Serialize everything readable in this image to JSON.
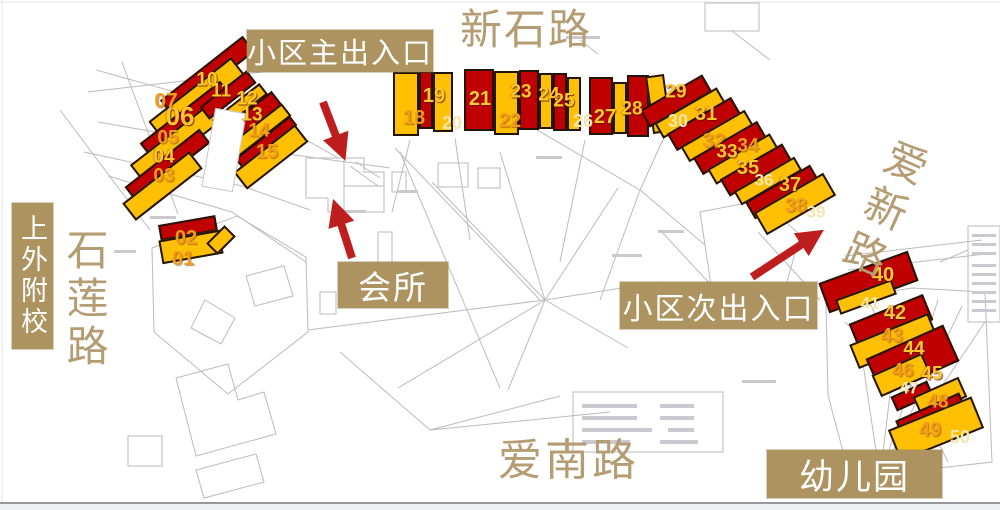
{
  "title": "小区楼栋分布图",
  "colors": {
    "building_red": "#C00000",
    "building_yellow": "#FFC003",
    "label_bg": "#AC9360",
    "label_text": "#FFFFFF",
    "road_text": "#B49C73",
    "arrow": "#BE1E1E",
    "num_bright": "#FFC82E",
    "num_orange": "#F29B1D",
    "num_pale": "#F3E6AE"
  },
  "annotations": {
    "main_entrance": {
      "text": "小区主出入口"
    },
    "clubhouse": {
      "text": "会所"
    },
    "secondary_entrance": {
      "text": "小区次出入口"
    },
    "kindergarten": {
      "text": "幼儿园"
    },
    "school": {
      "text": "上外附校"
    }
  },
  "roads": {
    "north": "新石路",
    "west": "石莲路",
    "south": "爱南路",
    "east": "爱新路"
  },
  "map": {
    "slabs_columns": [
      "cx",
      "cy",
      "w",
      "h",
      "rot_deg",
      "color R=red Y=yellow W=white-gap"
    ],
    "slabs": [
      [
        207,
        76,
        105,
        20,
        -38,
        "R"
      ],
      [
        196,
        98,
        105,
        22,
        -38,
        "Y"
      ],
      [
        186,
        120,
        102,
        20,
        -38,
        "R"
      ],
      [
        176,
        143,
        100,
        22,
        -38,
        "Y"
      ],
      [
        167,
        165,
        95,
        18,
        -38,
        "R"
      ],
      [
        162,
        186,
        85,
        22,
        -38,
        "Y"
      ],
      [
        228,
        95,
        60,
        16,
        -38,
        "R"
      ],
      [
        240,
        107,
        60,
        14,
        -38,
        "Y"
      ],
      [
        251,
        118,
        65,
        18,
        -38,
        "R"
      ],
      [
        259,
        131,
        70,
        16,
        -38,
        "Y"
      ],
      [
        266,
        142,
        70,
        12,
        -38,
        "R"
      ],
      [
        271,
        157,
        78,
        22,
        -38,
        "Y"
      ],
      [
        224,
        150,
        32,
        80,
        10,
        "W"
      ],
      [
        188,
        228,
        58,
        16,
        -10,
        "R"
      ],
      [
        191,
        247,
        62,
        24,
        -10,
        "Y"
      ],
      [
        221,
        240,
        26,
        16,
        -45,
        "Y"
      ],
      [
        406,
        104,
        26,
        64,
        0,
        "Y"
      ],
      [
        426,
        100,
        14,
        58,
        0,
        "R"
      ],
      [
        443,
        102,
        20,
        60,
        0,
        "Y"
      ],
      [
        479,
        100,
        30,
        62,
        0,
        "R"
      ],
      [
        506,
        103,
        25,
        64,
        0,
        "Y"
      ],
      [
        529,
        100,
        20,
        60,
        0,
        "R"
      ],
      [
        546,
        101,
        14,
        56,
        0,
        "Y"
      ],
      [
        560,
        102,
        14,
        58,
        0,
        "R"
      ],
      [
        574,
        104,
        14,
        54,
        0,
        "Y"
      ],
      [
        601,
        106,
        24,
        58,
        0,
        "R"
      ],
      [
        620,
        108,
        14,
        52,
        0,
        "Y"
      ],
      [
        638,
        106,
        22,
        62,
        0,
        "R"
      ],
      [
        658,
        104,
        19,
        58,
        -8,
        "Y"
      ],
      [
        676,
        101,
        72,
        20,
        -30,
        "R"
      ],
      [
        690,
        113,
        72,
        18,
        -30,
        "Y"
      ],
      [
        704,
        124,
        74,
        20,
        -30,
        "R"
      ],
      [
        717,
        136,
        74,
        18,
        -30,
        "Y"
      ],
      [
        730,
        148,
        74,
        20,
        -30,
        "R"
      ],
      [
        743,
        159,
        72,
        18,
        -30,
        "Y"
      ],
      [
        756,
        170,
        72,
        20,
        -30,
        "R"
      ],
      [
        768,
        181,
        70,
        16,
        -30,
        "Y"
      ],
      [
        782,
        192,
        75,
        20,
        -30,
        "R"
      ],
      [
        795,
        204,
        80,
        26,
        -30,
        "Y"
      ],
      [
        868,
        282,
        95,
        32,
        -20,
        "R"
      ],
      [
        866,
        297,
        60,
        16,
        -20,
        "Y"
      ],
      [
        891,
        322,
        80,
        28,
        -22,
        "R"
      ],
      [
        893,
        341,
        85,
        26,
        -22,
        "Y"
      ],
      [
        912,
        360,
        85,
        40,
        -24,
        "R"
      ],
      [
        901,
        375,
        55,
        24,
        -24,
        "Y"
      ],
      [
        912,
        396,
        40,
        16,
        -24,
        "R"
      ],
      [
        940,
        397,
        50,
        22,
        -24,
        "Y"
      ],
      [
        930,
        413,
        70,
        14,
        -24,
        "R"
      ],
      [
        936,
        429,
        90,
        34,
        -22,
        "Y"
      ]
    ],
    "units_columns": [
      "building_number",
      "x",
      "y",
      "tone b=bright o=orange p=pale",
      "font_px"
    ],
    "units": [
      [
        "01",
        183,
        259,
        "o",
        20
      ],
      [
        "02",
        186,
        238,
        "o",
        20
      ],
      [
        "03",
        164,
        176,
        "o",
        19
      ],
      [
        "04",
        164,
        157,
        "b",
        19
      ],
      [
        "05",
        168,
        138,
        "o",
        19
      ],
      [
        "06",
        180,
        116,
        "b",
        26
      ],
      [
        "07",
        166,
        101,
        "o",
        21
      ],
      [
        "10",
        207,
        80,
        "b",
        19
      ],
      [
        "11",
        221,
        91,
        "b",
        19
      ],
      [
        "12",
        247,
        99,
        "b",
        19
      ],
      [
        "13",
        252,
        115,
        "b",
        19
      ],
      [
        "14",
        259,
        131,
        "o",
        19
      ],
      [
        "15",
        267,
        152,
        "o",
        20
      ],
      [
        "18",
        414,
        118,
        "o",
        20
      ],
      [
        "19",
        434,
        96,
        "b",
        20
      ],
      [
        "20",
        452,
        123,
        "p",
        18
      ],
      [
        "21",
        480,
        99,
        "b",
        20
      ],
      [
        "22",
        510,
        121,
        "o",
        20
      ],
      [
        "23",
        521,
        92,
        "b",
        19
      ],
      [
        "24",
        549,
        95,
        "b",
        19
      ],
      [
        "25",
        564,
        101,
        "b",
        19
      ],
      [
        "26",
        583,
        121,
        "p",
        18
      ],
      [
        "27",
        605,
        117,
        "b",
        20
      ],
      [
        "28",
        632,
        109,
        "b",
        19
      ],
      [
        "29",
        676,
        92,
        "b",
        19
      ],
      [
        "30",
        678,
        121,
        "p",
        18
      ],
      [
        "31",
        706,
        114,
        "b",
        20
      ],
      [
        "32",
        714,
        141,
        "o",
        21
      ],
      [
        "33",
        727,
        152,
        "b",
        19
      ],
      [
        "34",
        748,
        146,
        "o",
        19
      ],
      [
        "35",
        748,
        168,
        "b",
        20
      ],
      [
        "36",
        764,
        180,
        "p",
        17
      ],
      [
        "37",
        790,
        185,
        "b",
        20
      ],
      [
        "38",
        796,
        206,
        "o",
        20
      ],
      [
        "39",
        816,
        212,
        "p",
        17
      ],
      [
        "40",
        883,
        275,
        "b",
        20
      ],
      [
        "41",
        870,
        303,
        "p",
        17
      ],
      [
        "42",
        895,
        313,
        "b",
        20
      ],
      [
        "43",
        892,
        336,
        "o",
        20
      ],
      [
        "44",
        914,
        349,
        "b",
        19
      ],
      [
        "45",
        932,
        374,
        "b",
        19
      ],
      [
        "46",
        903,
        371,
        "o",
        19
      ],
      [
        "47",
        909,
        388,
        "p",
        17
      ],
      [
        "48",
        938,
        402,
        "o",
        19
      ],
      [
        "49",
        930,
        430,
        "o",
        20
      ],
      [
        "50",
        960,
        437,
        "p",
        18
      ]
    ],
    "arrows_columns": [
      "x1",
      "y1",
      "x2",
      "y2"
    ],
    "arrows": [
      [
        323,
        102,
        342,
        152
      ],
      [
        352,
        258,
        336,
        208
      ],
      [
        752,
        277,
        816,
        235
      ]
    ]
  }
}
